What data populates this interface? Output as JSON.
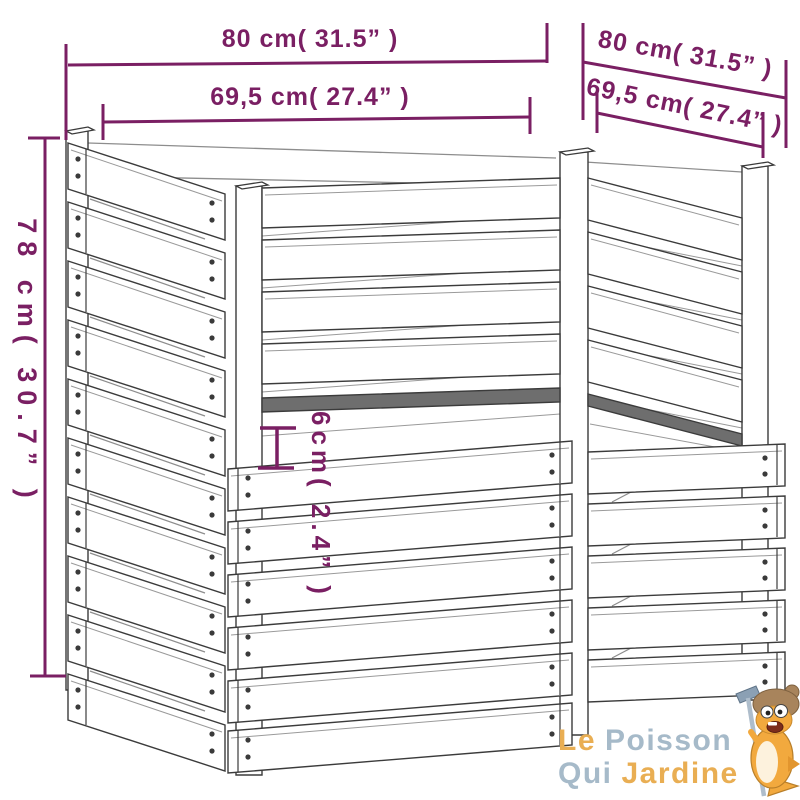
{
  "diagram": {
    "title": "composter-dimension-drawing",
    "dimensions": {
      "overall_width": "80 cm( 31.5” )",
      "overall_depth": "80 cm( 31.5” )",
      "inner_width": "69,5 cm( 27.4” )",
      "inner_depth": "69,5 cm( 27.4” )",
      "overall_height": "78 cm( 30.7” )",
      "slat_gap": "6cm( 2.4” )"
    },
    "colors": {
      "dimension_accent": "#7a1f63",
      "drawing_line": "#3b3b3b"
    }
  },
  "logo": {
    "word_le": "Le",
    "word_poisson": "Poisson",
    "word_qui": "Qui",
    "word_jardine": "Jardine",
    "colors": {
      "orange": "#e9ae53",
      "blue": "#a6bac9"
    }
  }
}
